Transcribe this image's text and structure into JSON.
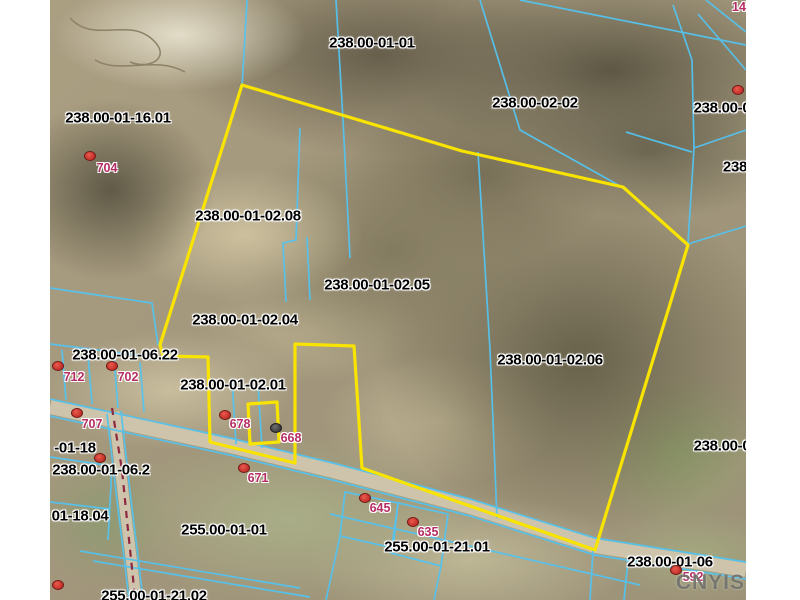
{
  "map": {
    "watermark": "CNYIS",
    "colors": {
      "background": "#ffffff",
      "parcel_line": "#54c3ef",
      "highlight_boundary": "#f8e400",
      "parcel_label_text": "#000000",
      "address_label_text": "#b52d62",
      "address_dot": "#c22f2a",
      "address_dot_dark": "#3d3d3d",
      "municipal_boundary_dash": "#8f2740",
      "road_fill": "#cdc4ab"
    },
    "parcel_labels": [
      {
        "text": "238.00-01-01",
        "x": 372,
        "y": 43
      },
      {
        "text": "238.00-02-02",
        "x": 535,
        "y": 103
      },
      {
        "text": "238.00-02",
        "x": 726,
        "y": 108
      },
      {
        "text": "238",
        "x": 735,
        "y": 167
      },
      {
        "text": "238.00-01-16.01",
        "x": 118,
        "y": 118
      },
      {
        "text": "238.00-01-02.08",
        "x": 248,
        "y": 216
      },
      {
        "text": "238.00-01-02.05",
        "x": 377,
        "y": 285
      },
      {
        "text": "238.00-01-02.04",
        "x": 245,
        "y": 320
      },
      {
        "text": "238.00-01-06.22",
        "x": 125,
        "y": 355
      },
      {
        "text": "238.00-01-02.01",
        "x": 233,
        "y": 385
      },
      {
        "text": "238.00-01-02.06",
        "x": 550,
        "y": 360
      },
      {
        "text": "-01-18",
        "x": 75,
        "y": 448
      },
      {
        "text": "238.00-01-06.2",
        "x": 101,
        "y": 470
      },
      {
        "text": "01-18.04",
        "x": 80,
        "y": 516
      },
      {
        "text": "255.00-01-01",
        "x": 224,
        "y": 530
      },
      {
        "text": "255.00-01-21.01",
        "x": 437,
        "y": 547
      },
      {
        "text": "238.00-01-06",
        "x": 670,
        "y": 562
      },
      {
        "text": "238.00-0",
        "x": 722,
        "y": 446
      },
      {
        "text": "255.00-01-21.02",
        "x": 154,
        "y": 596
      }
    ],
    "address_points": [
      {
        "label": "704",
        "lx": 107,
        "ly": 168,
        "dx": 90,
        "dy": 156,
        "variant": "red"
      },
      {
        "label": "712",
        "lx": 74,
        "ly": 377,
        "dx": 58,
        "dy": 366,
        "variant": "red"
      },
      {
        "label": "702",
        "lx": 128,
        "ly": 377,
        "dx": 112,
        "dy": 366,
        "variant": "red"
      },
      {
        "label": "707",
        "lx": 92,
        "ly": 424,
        "dx": 77,
        "dy": 413,
        "variant": "red"
      },
      {
        "label": "678",
        "lx": 240,
        "ly": 424,
        "dx": 225,
        "dy": 415,
        "variant": "red"
      },
      {
        "label": "668",
        "lx": 291,
        "ly": 438,
        "dx": 276,
        "dy": 428,
        "variant": "dark"
      },
      {
        "label": "671",
        "lx": 258,
        "ly": 478,
        "dx": 244,
        "dy": 468,
        "variant": "red"
      },
      {
        "label": "645",
        "lx": 380,
        "ly": 508,
        "dx": 365,
        "dy": 498,
        "variant": "red"
      },
      {
        "label": "635",
        "lx": 428,
        "ly": 532,
        "dx": 413,
        "dy": 522,
        "variant": "red"
      },
      {
        "label": "592",
        "lx": 693,
        "ly": 577,
        "dx": 676,
        "dy": 570,
        "variant": "red"
      },
      {
        "label": "14",
        "lx": 739,
        "ly": 7,
        "dx": null,
        "dy": null,
        "variant": "red"
      }
    ],
    "unlabeled_dots": [
      {
        "x": 738,
        "y": 90
      },
      {
        "x": 100,
        "y": 458
      },
      {
        "x": 58,
        "y": 585
      }
    ]
  }
}
